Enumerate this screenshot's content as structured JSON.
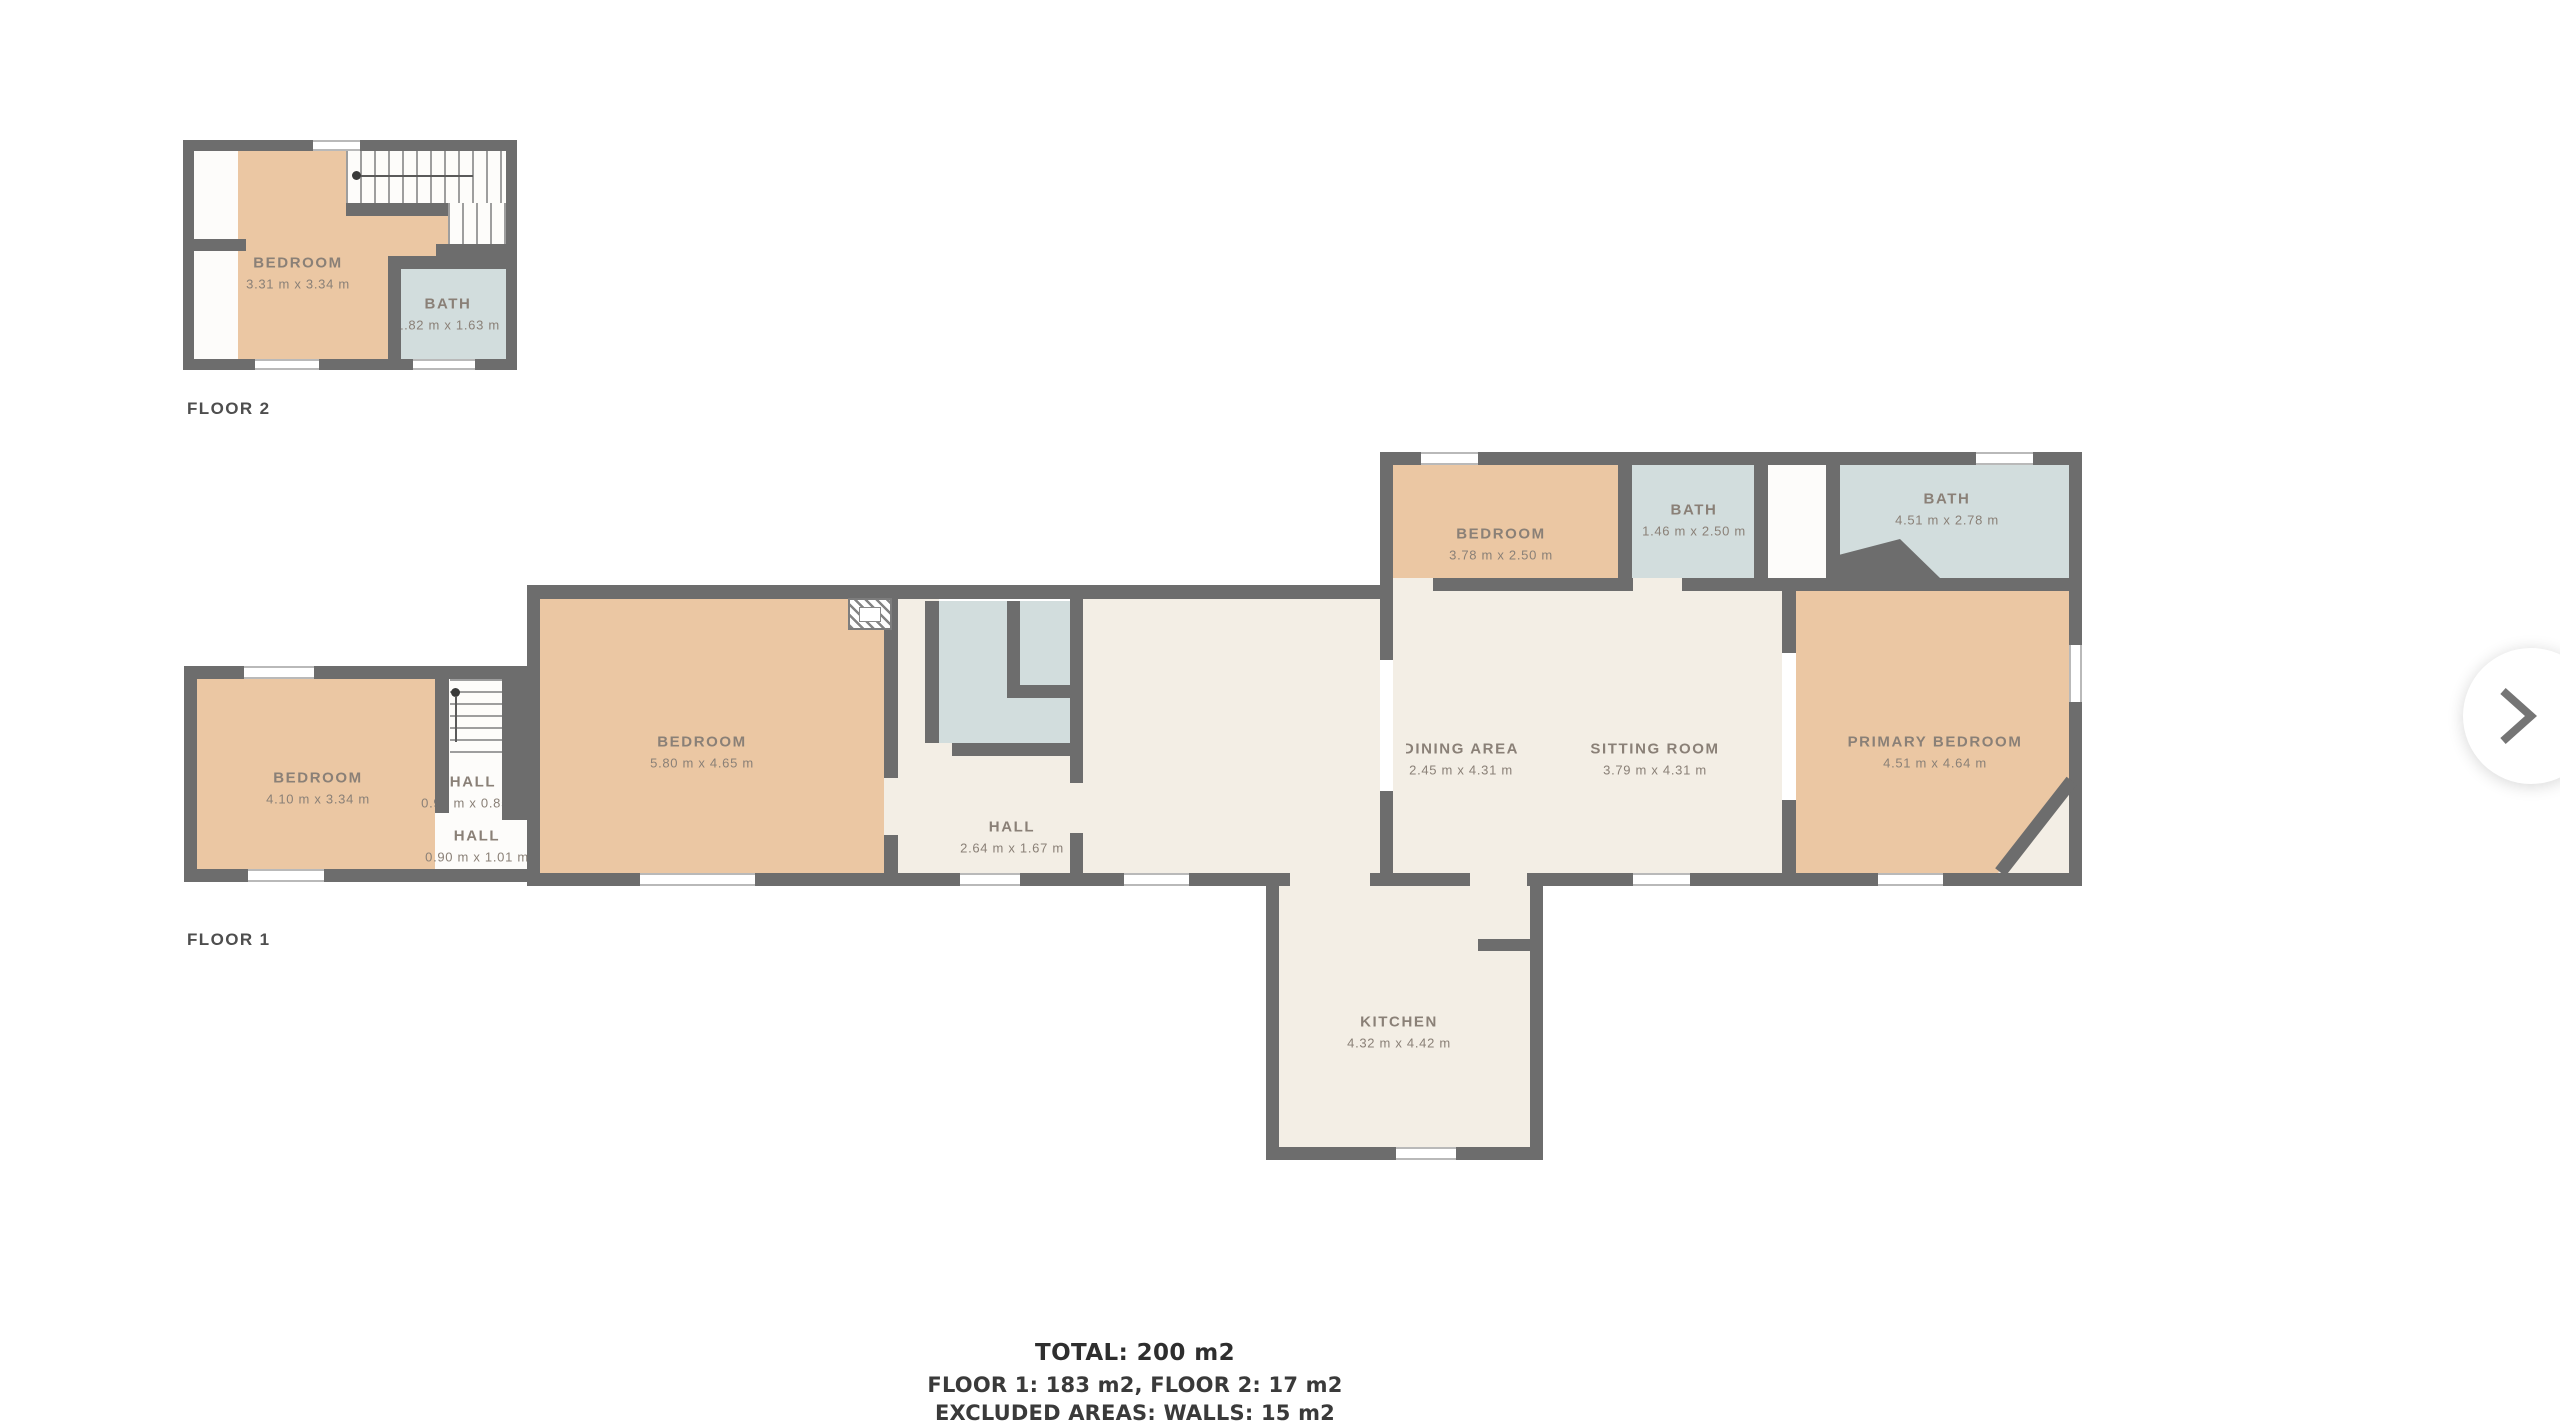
{
  "colors": {
    "background": "#ffffff",
    "wall": "#6d6d6d",
    "room_tan": "#ebc7a3",
    "room_blue": "#d2dddd",
    "room_cream": "#f3eee5",
    "room_white": "#fdfcfa",
    "window": "#ffffff",
    "window_line": "#b9b9b9",
    "stair_line": "#9e9e9e",
    "label_text": "#8a8077",
    "caption_text": "#4e4e4e",
    "summary_text": "#2e2e2e",
    "chevron": "#757575"
  },
  "floor2": {
    "label": "FLOOR 2",
    "bedroom": {
      "name": "BEDROOM",
      "dims": "3.31 m x 3.34 m"
    },
    "bath": {
      "name": "BATH",
      "dims": "1.82 m x 1.63 m"
    }
  },
  "floor1": {
    "label": "FLOOR 1",
    "bedroom_left": {
      "name": "BEDROOM",
      "dims": "4.10 m x 3.34 m"
    },
    "hall_upper": {
      "name": "HALL",
      "dims": "0.92 m x 0.85 m"
    },
    "hall_lower": {
      "name": "HALL",
      "dims": "0.90 m x 1.01 m"
    },
    "bedroom_center": {
      "name": "BEDROOM",
      "dims": "5.80 m x 4.65 m"
    },
    "hall_main": {
      "name": "HALL",
      "dims": "2.64 m x 1.67 m"
    },
    "bedroom_right": {
      "name": "BEDROOM",
      "dims": "3.78 m x 2.50 m"
    },
    "bath_small": {
      "name": "BATH",
      "dims": "1.46 m x 2.50 m"
    },
    "bath_large": {
      "name": "BATH",
      "dims": "4.51 m x 2.78 m"
    },
    "dining": {
      "name": "DINING AREA",
      "dims": "2.45 m x 4.31 m"
    },
    "sitting": {
      "name": "SITTING ROOM",
      "dims": "3.79 m x 4.31 m"
    },
    "primary": {
      "name": "PRIMARY BEDROOM",
      "dims": "4.51 m x 4.64 m"
    },
    "kitchen": {
      "name": "KITCHEN",
      "dims": "4.32 m x 4.42 m"
    }
  },
  "summary": {
    "total": "TOTAL: 200 m2",
    "floors": "FLOOR 1: 183 m2, FLOOR 2: 17 m2",
    "excluded": "EXCLUDED AREAS: WALLS: 15 m2"
  },
  "nav": {
    "next_icon": "chevron-right"
  }
}
